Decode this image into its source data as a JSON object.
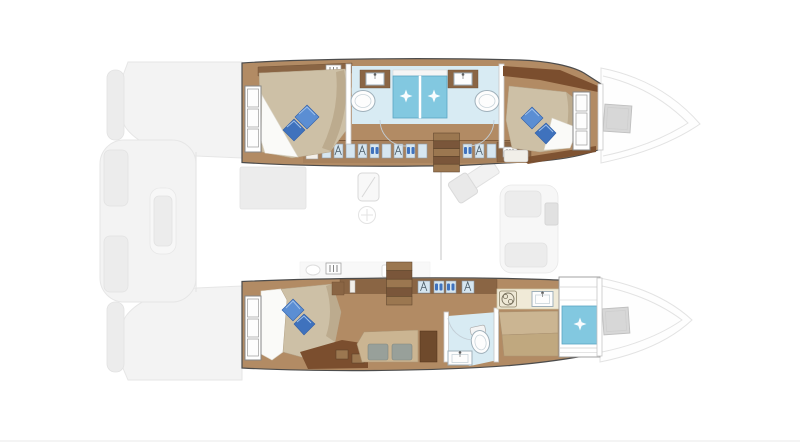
{
  "meta": {
    "title": "Catamaran yacht interior floor plan, top-down view, bow to the right"
  },
  "palette": {
    "hullOutline": "#4c4c4c",
    "wood": "#b28b64",
    "cabinet": "#a8825d",
    "cabinetDark": "#8a6544",
    "woodDarker": "#7b4e2e",
    "bedTan": "#cdc0a6",
    "bedShade": "#bcab8e",
    "sheetWhite": "#fafaf8",
    "pillowBlue": "#5b8ed3",
    "pillowBlueDark": "#3f72bd",
    "bathFloor": "#d8ebf3",
    "shower": "#82c8e0",
    "showerDark": "#5ba6c4",
    "fixtureWhite": "#fdfdfd",
    "fixtureStroke": "#9fb0ba",
    "wardrobeInset": "#d6e6f0",
    "counterCream": "#f0ead7",
    "stepLight": "#9b7750",
    "stepDark": "#7a563a",
    "wallStroke": "#c6c6c6",
    "cushionGray": "#98a09a",
    "deskBrown": "#6f4a2c",
    "fadedFill": "#f3f3f3",
    "fadedStroke": "#e6e6e6",
    "hatchGray": "#d7d7d7"
  },
  "plan": {
    "orientation": {
      "bow": "right",
      "stern": "left"
    },
    "port_hull": {
      "label": "port-hull",
      "rooms": [
        "aft-cabin",
        "aft-bathroom",
        "forward-bathroom",
        "forward-cabin"
      ],
      "features": {
        "double_berths": 2,
        "blue_pillows_per_bed": 2,
        "showers": 2,
        "washbasins": 2,
        "vanities": 2,
        "wardrobes": true,
        "hull_windows": 2,
        "companionway_steps": 1
      }
    },
    "starboard_hull": {
      "label": "starboard-owner-hull",
      "rooms": [
        "owner-aft-cabin",
        "lounge",
        "bathroom",
        "forward-shower-room"
      ],
      "features": {
        "double_berths": 1,
        "blue_pillows_per_bed": 2,
        "sofa_cushions": 2,
        "desk": 1,
        "toilet": 1,
        "washbasins": 2,
        "stove": 1,
        "shower": 1,
        "wardrobes": true,
        "hull_windows": 1,
        "companionway_steps": 1
      }
    },
    "main_deck_faded": {
      "label": "saloon-galley-and-cockpit",
      "elements": [
        "aft-cockpit-benches",
        "saloon-table",
        "fridge",
        "galley-fixtures",
        "nav-station",
        "foredeck-bench"
      ]
    },
    "bows": {
      "deck_hatches": 2
    }
  }
}
